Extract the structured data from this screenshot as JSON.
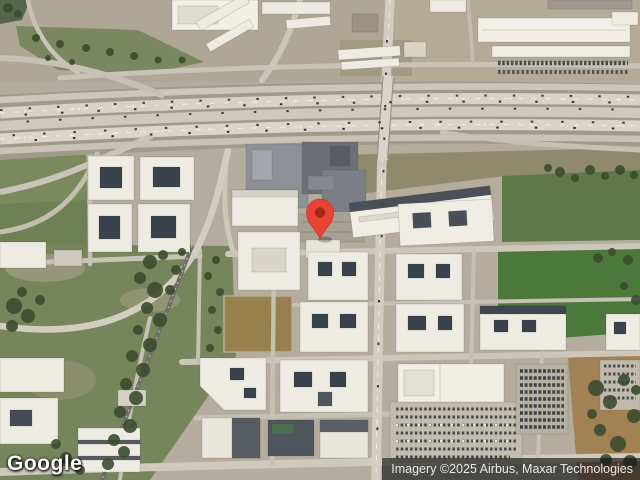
{
  "map": {
    "kind": "satellite-imagery",
    "scene": "aerial view: highway interchange across upper third, office campus and apartment blocks with courtyards, warehouses top-right, green fields, rail line lower-left, retail parking lower-right",
    "provider_logo": "Google",
    "attribution": "Imagery ©2025 Airbus, Maxar Technologies",
    "palette": {
      "ground": "#b4ad9e",
      "road": "#d4cfc1",
      "grass": "#6f8154",
      "bright_grass": "#4c783c",
      "trees": "#3d4b30",
      "dirt": "#96804e",
      "building": "#eeece2",
      "dark_roof": "#565b61",
      "attribution_bar": "#161616"
    }
  },
  "marker": {
    "name": "location-pin",
    "x": 320,
    "y": 239,
    "color": "#EA4335",
    "inner_color": "#A52714"
  }
}
